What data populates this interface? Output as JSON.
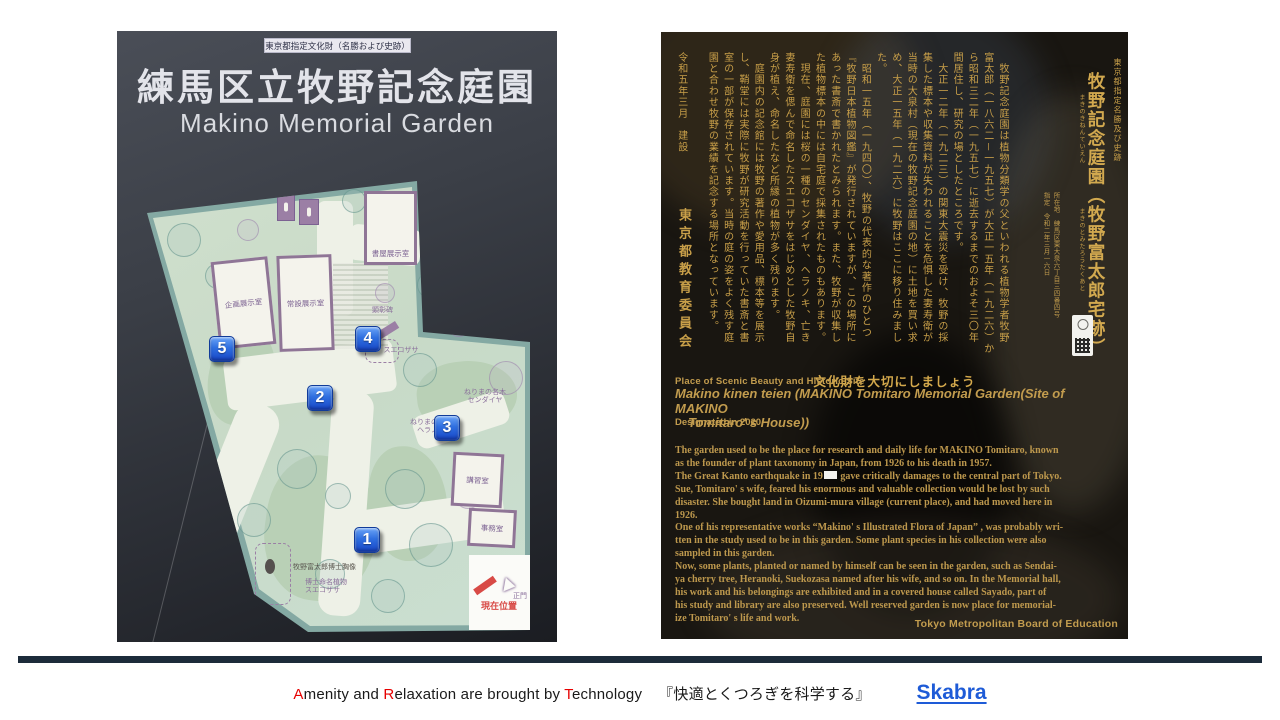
{
  "left_photo": {
    "banner": "東京都指定文化財（名勝および史跡）",
    "title_ja": "練馬区立牧野記念庭園",
    "title_en": "Makino Memorial Garden",
    "map": {
      "buildings": {
        "kikaku": "企画展示室",
        "josetsu": "常設展示室",
        "shooku": "書屋展示室",
        "koshu": "講習室",
        "jimu": "事務室"
      },
      "labels": {
        "kenshohi": "顕彰碑",
        "sendaiya": "ねりまの名木\nセンダイヤ",
        "heranoki": "ねりまの名木\nヘラノ木",
        "suekozasa_near4": "スエコザサ",
        "bust": "牧野富太郎博士胸像",
        "suekozasa": "博士命名植物\nスエコザサ",
        "seimon": "正門",
        "genzai": "現在位置"
      },
      "markers": [
        "1",
        "2",
        "3",
        "4",
        "5"
      ]
    }
  },
  "right_photo": {
    "header_small": "東京都指定名勝及び史跡",
    "title": "牧野記念庭園（牧野富太郎宅跡）",
    "furigana_1": "まきのきねんていえん",
    "furigana_2": "まきのとみたろうたくあと",
    "info": "所在地　練馬区東大泉六丁目三四番四号\n指定　令和二年三月一六日",
    "body": "　牧野記念庭園は植物分類学の父といわれる植物学者牧野\n富太郎（一八六二－一九五七）が大正一五年（一九二六）か\nら昭和三二年（一九五七）に逝去するまでのおよそ三〇年\n間居住し、研究の場としたところです。\n　大正一二年（一九二三）の関東大震災を受け、牧野の採\n集した標本や収集資料が失われることを危惧した妻寿衛が\n当時の大泉村（現在の牧野記念庭園の地）に土地を買い求\nめ、大正一五年（一九二六）に牧野はここに移り住みまし\nた。\n　昭和一五年（一九四〇）、牧野の代表的な著作のひとつ\n『牧野日本植物図鑑』が発行されていますが、この場所に\nあった書斎で書かれたとみられます。また、牧野が収集し\nた植物標本の中には自宅庭で採集されたものもあります。\n　現在、庭園には桜の一種のセンダイヤ、ヘラノキ、亡き\n妻寿衛を偲んで命名したスエコザサをはじめとした牧野自\n身が植え、命名したなど所縁の植物が多く残ります。\n　庭園内の記念館には牧野の著作や愛用品、標本等を展示\nし、鞘堂には実際に牧野が研究活動を行っていた書斎と書\n室の一部が保存されています。当時の庭の姿をよく残す庭\n園と合わせ牧野の業績を記念する場所となっています。\n\n令和五年三月　建設",
    "board_ja": "東京都教育委員会",
    "slogan": "文化財を大切にしましょう",
    "english": {
      "heading": "Place of Scenic Beauty and Historic Site",
      "title": "Makino kinen teien (MAKINO  Tomitaro Memorial Garden(Site of MAKINO\n　Tomitaro' s House))",
      "designated": "Designated in 2020",
      "body_a": "The garden used to be the place for research and daily life for MAKINO Tomitaro, known\nas the founder of plant taxonomy in Japan, from 1926 to his death in 1957.\nThe Great Kanto earthquake in 19",
      "body_b": " gave critically damages to the central part of Tokyo.\nSue, Tomitaro' s wife, feared his enormous and valuable collection would be lost by such\ndisaster. She bought land in Oizumi-mura village (current place), and had moved here in\n1926.\nOne of his representative works “Makino' s Illustrated Flora of Japan” , was probably wri-\ntten in the study used to be in this garden. Some plant species in his collection were also\nsampled in this garden.\nNow, some plants, planted or named by himself can be seen in the garden, such as Sendai-\nya cherry tree, Heranoki, Suekozasa named after his wife, and so on. In the Memorial hall,\nhis work and his belongings are exhibited and in a covered house called Sayado, part of\nhis study and library are also preserved. Well reserved garden is now place for memorial-\nize Tomitaro' s life and work.",
      "board": "Tokyo Metropolitan Board of Education"
    }
  },
  "footer": {
    "tagline_segments": [
      "A",
      "menity and ",
      "R",
      "elaxation are brought by ",
      "T",
      "echnology"
    ],
    "tagline_jp": "『快適とくつろぎを科学する』",
    "brand": "Skabra"
  }
}
